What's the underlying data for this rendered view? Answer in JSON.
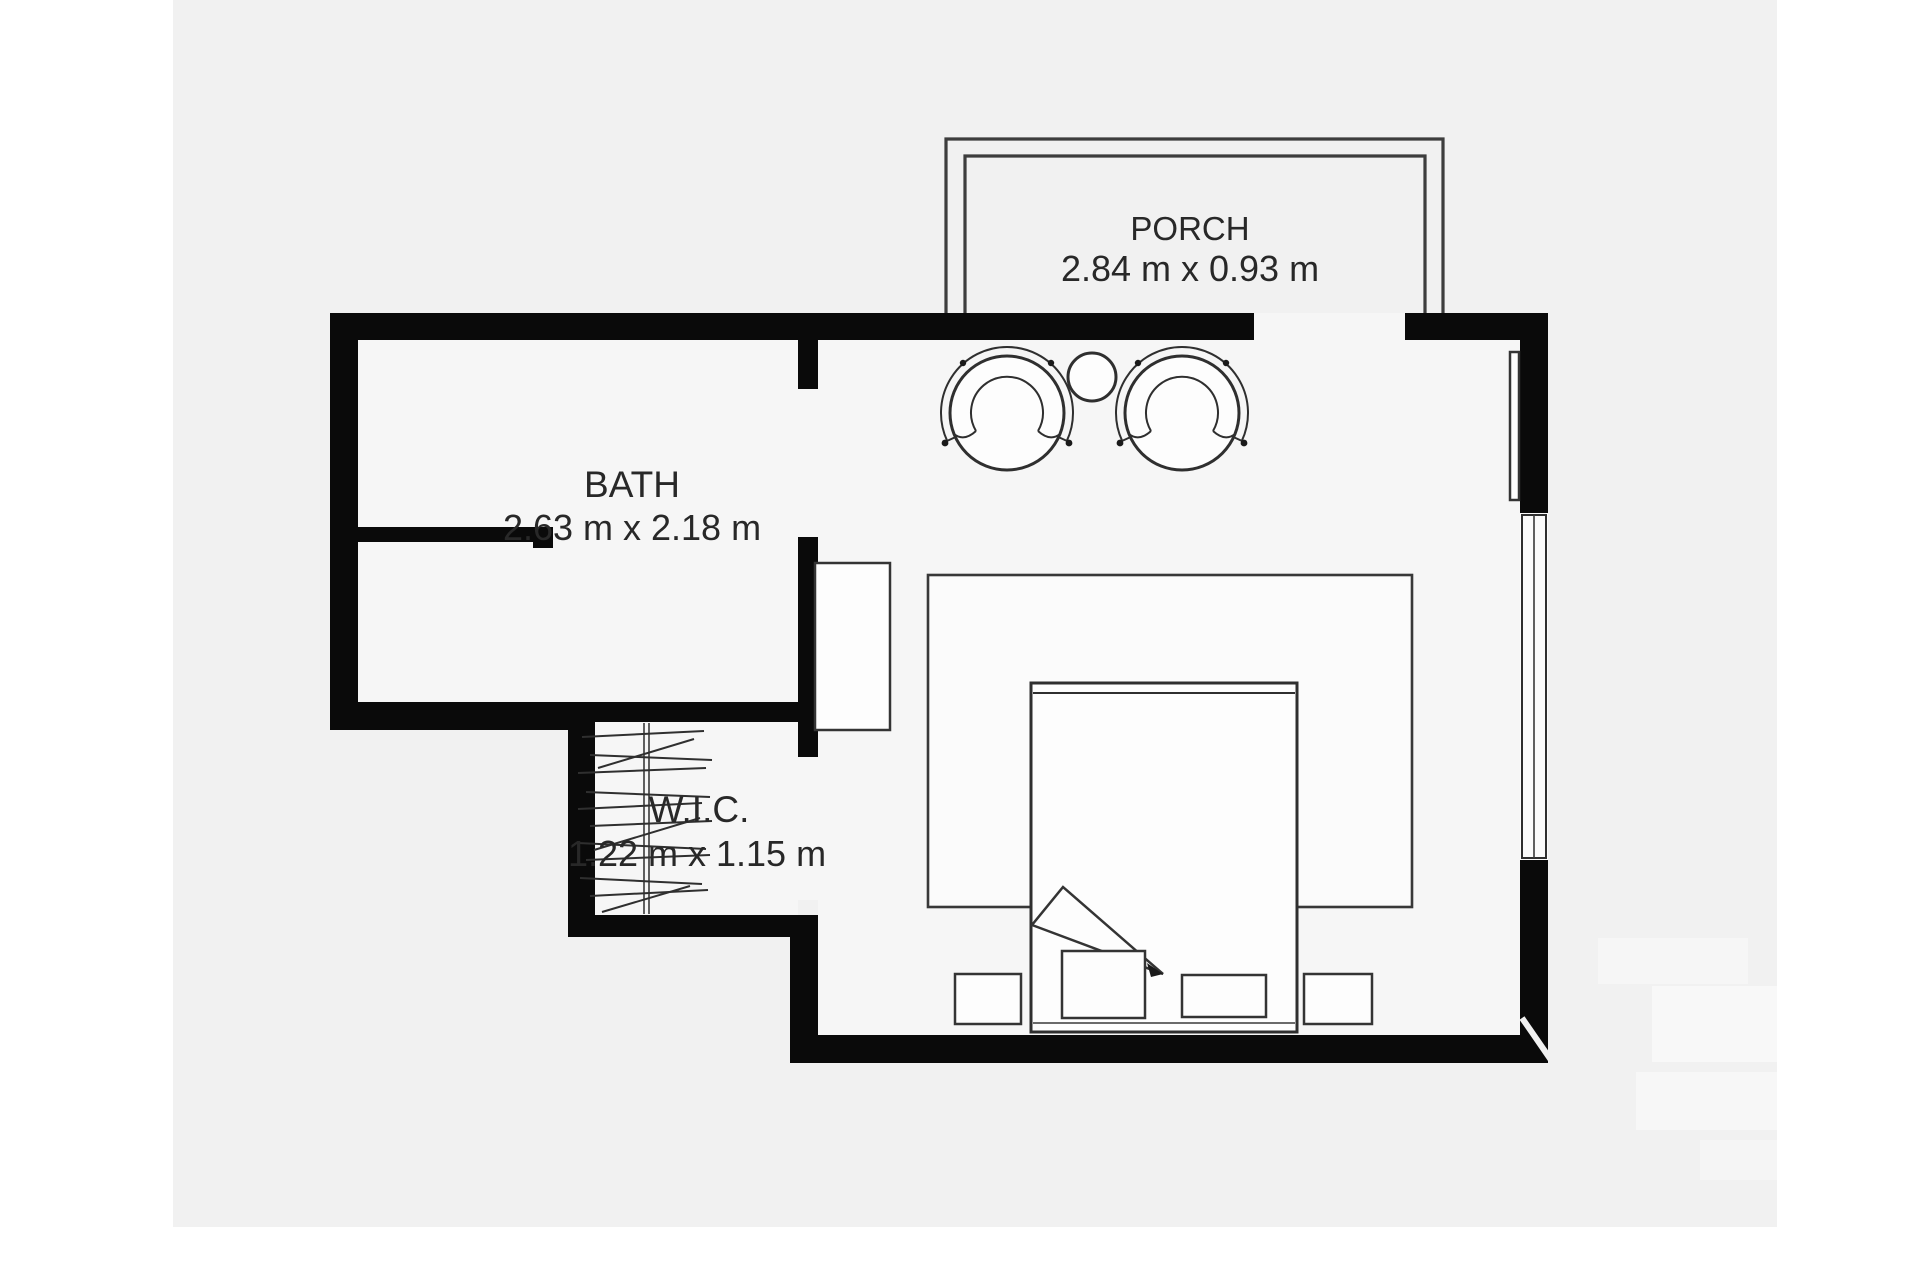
{
  "document": {
    "type": "floor-plan",
    "background_color": "#ffffff",
    "canvas_color": "#f1f1f1",
    "wall_color": "#0a0a0a",
    "line_color": "#2f2f2f",
    "text_color": "#282828"
  },
  "rooms": {
    "porch": {
      "name": "PORCH",
      "dimensions": "2.84 m x 0.93 m"
    },
    "bath": {
      "name": "BATH",
      "dimensions": "2.63 m x 2.18 m"
    },
    "wic": {
      "name": "W.I.C.",
      "dimensions": "1.22 m x 1.15 m"
    }
  },
  "furniture_icons": [
    "armchair-left-icon",
    "armchair-right-icon",
    "round-side-table-icon",
    "rug-icon",
    "double-bed-icon",
    "blanket-fold-icon",
    "floor-cushion-icon",
    "dresser-icon",
    "closet-rod-hangers-icon",
    "window-icon",
    "wall-mirror-icon",
    "porch-railing-icon"
  ]
}
